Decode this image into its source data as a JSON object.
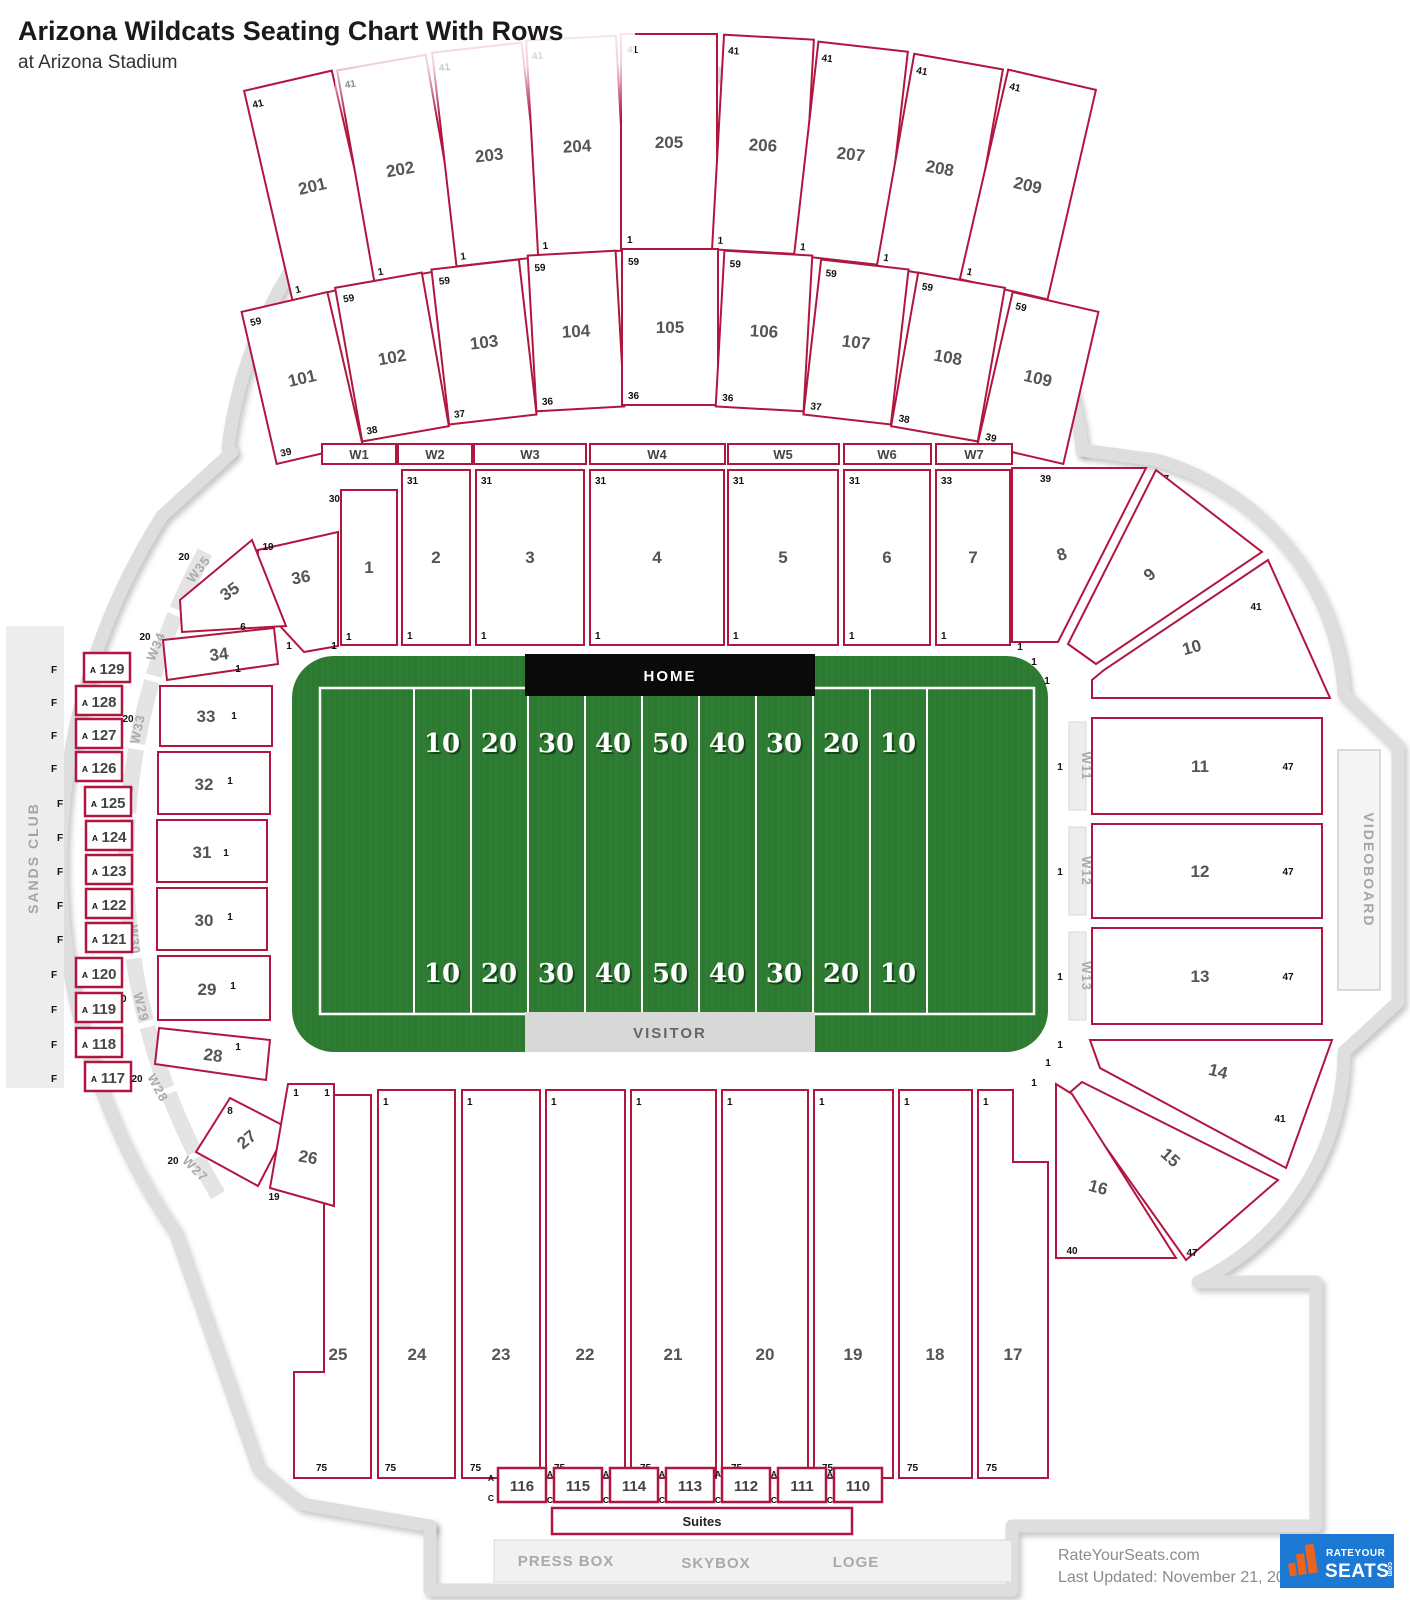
{
  "m": {
    "n1": "1",
    "n6": "6",
    "n8": "8",
    "n19": "19",
    "n20": "20",
    "n30": "30",
    "n31": "31",
    "n33": "33",
    "n36": "36",
    "n37": "37",
    "n38": "38",
    "n39": "39",
    "n40": "40",
    "n41": "41",
    "n47": "47",
    "n59": "59",
    "n75": "75",
    "a": "A",
    "c": "C",
    "f": "F"
  },
  "header": {
    "title": "Arizona Wildcats Seating Chart With Rows",
    "subtitle": "at Arizona Stadium"
  },
  "field": {
    "home": "HOME",
    "visitor": "VISITOR",
    "yards": [
      "10",
      "20",
      "30",
      "40",
      "50",
      "40",
      "30",
      "20",
      "10"
    ]
  },
  "l200": [
    "201",
    "202",
    "203",
    "204",
    "205",
    "206",
    "207",
    "208",
    "209"
  ],
  "l100": [
    {
      "n": "101",
      "b": "39"
    },
    {
      "n": "102",
      "b": "38"
    },
    {
      "n": "103",
      "b": "37"
    },
    {
      "n": "104",
      "b": "36"
    },
    {
      "n": "105",
      "b": "36"
    },
    {
      "n": "106",
      "b": "36"
    },
    {
      "n": "107",
      "b": "37"
    },
    {
      "n": "108",
      "b": "38"
    },
    {
      "n": "109",
      "b": "39"
    }
  ],
  "walkN": [
    "W1",
    "W2",
    "W3",
    "W4",
    "W5",
    "W6",
    "W7"
  ],
  "north": [
    {
      "n": "1",
      "t": "30"
    },
    {
      "n": "2",
      "t": "31"
    },
    {
      "n": "3",
      "t": "31"
    },
    {
      "n": "4",
      "t": "31"
    },
    {
      "n": "5",
      "t": "31"
    },
    {
      "n": "6",
      "t": "31"
    },
    {
      "n": "7",
      "t": "33"
    }
  ],
  "corner": [
    "8",
    "9",
    "10",
    "14",
    "15",
    "16"
  ],
  "east": {
    "secs": [
      "11",
      "12",
      "13"
    ],
    "walks": [
      "W11",
      "W12",
      "W13"
    ],
    "videoboard": "VIDEOBOARD"
  },
  "south": [
    "25",
    "24",
    "23",
    "22",
    "21",
    "20",
    "19",
    "18",
    "17"
  ],
  "suites": {
    "boxes": [
      "116",
      "115",
      "114",
      "113",
      "112",
      "111",
      "110"
    ],
    "label": "Suites"
  },
  "club": [
    "PRESS BOX",
    "SKYBOX",
    "LOGE"
  ],
  "west": {
    "sands": "SANDS CLUB",
    "boxes": [
      "129",
      "128",
      "127",
      "126",
      "125",
      "124",
      "123",
      "122",
      "121",
      "120",
      "119",
      "118",
      "117"
    ],
    "walks": [
      "W35",
      "W34",
      "W33",
      "W32",
      "W31",
      "W30",
      "W29",
      "W28",
      "W27"
    ],
    "secs": [
      "36",
      "35",
      "34",
      "33",
      "32",
      "31",
      "30",
      "29",
      "28",
      "27",
      "26"
    ]
  },
  "footer": {
    "site": "RateYourSeats.com",
    "updated": "Last Updated: November 21, 2025",
    "logo_top": "RATEYOUR",
    "logo_main": "SEATS",
    "logo_com": "com"
  }
}
